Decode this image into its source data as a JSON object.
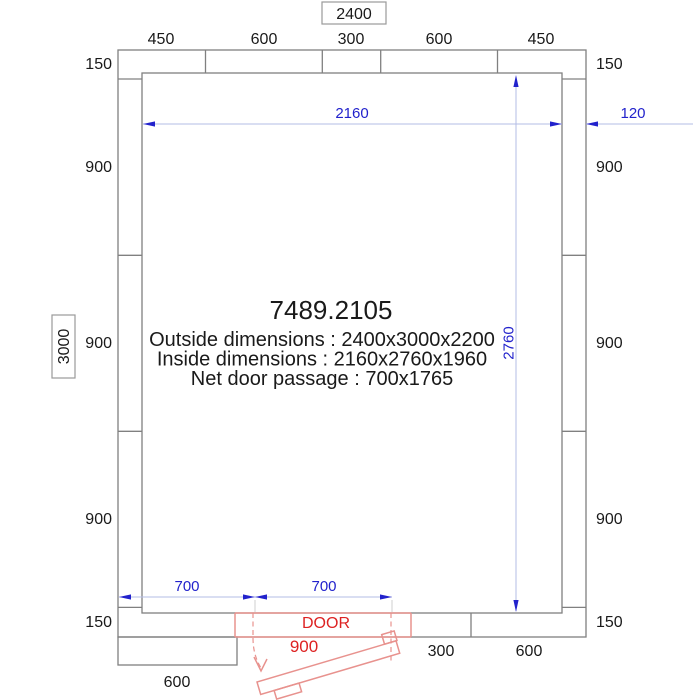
{
  "product": {
    "code": "7489.2105",
    "outside_dimensions": "Outside dimensions : 2400x3000x2200",
    "inside_dimensions": "Inside dimensions :  2160x2760x1960",
    "net_door_passage": "Net door passage : 700x1765"
  },
  "overall": {
    "width": "2400",
    "height": "3000"
  },
  "panels": {
    "top": [
      "450",
      "600",
      "300",
      "600",
      "450"
    ],
    "left": [
      "150",
      "900",
      "900",
      "900",
      "150"
    ],
    "right": [
      "150",
      "900",
      "900",
      "900",
      "150"
    ],
    "bottom": [
      "300",
      "600"
    ],
    "bottom_offset_panel": "600"
  },
  "dims": {
    "inside_width": "2160",
    "inside_height": "2760",
    "wall_thickness": "120",
    "door_offset_left": "700",
    "door_net_passage": "700",
    "door_frame_width": "900"
  },
  "door": {
    "label": "DOOR"
  },
  "colors": {
    "wall_line": "#808080",
    "text": "#1a1a1a",
    "dimension_blue": "#2222cc",
    "dimension_blue_light": "#b3bce6",
    "door_red_text": "#dd2222",
    "door_red_line": "#e8928e"
  }
}
